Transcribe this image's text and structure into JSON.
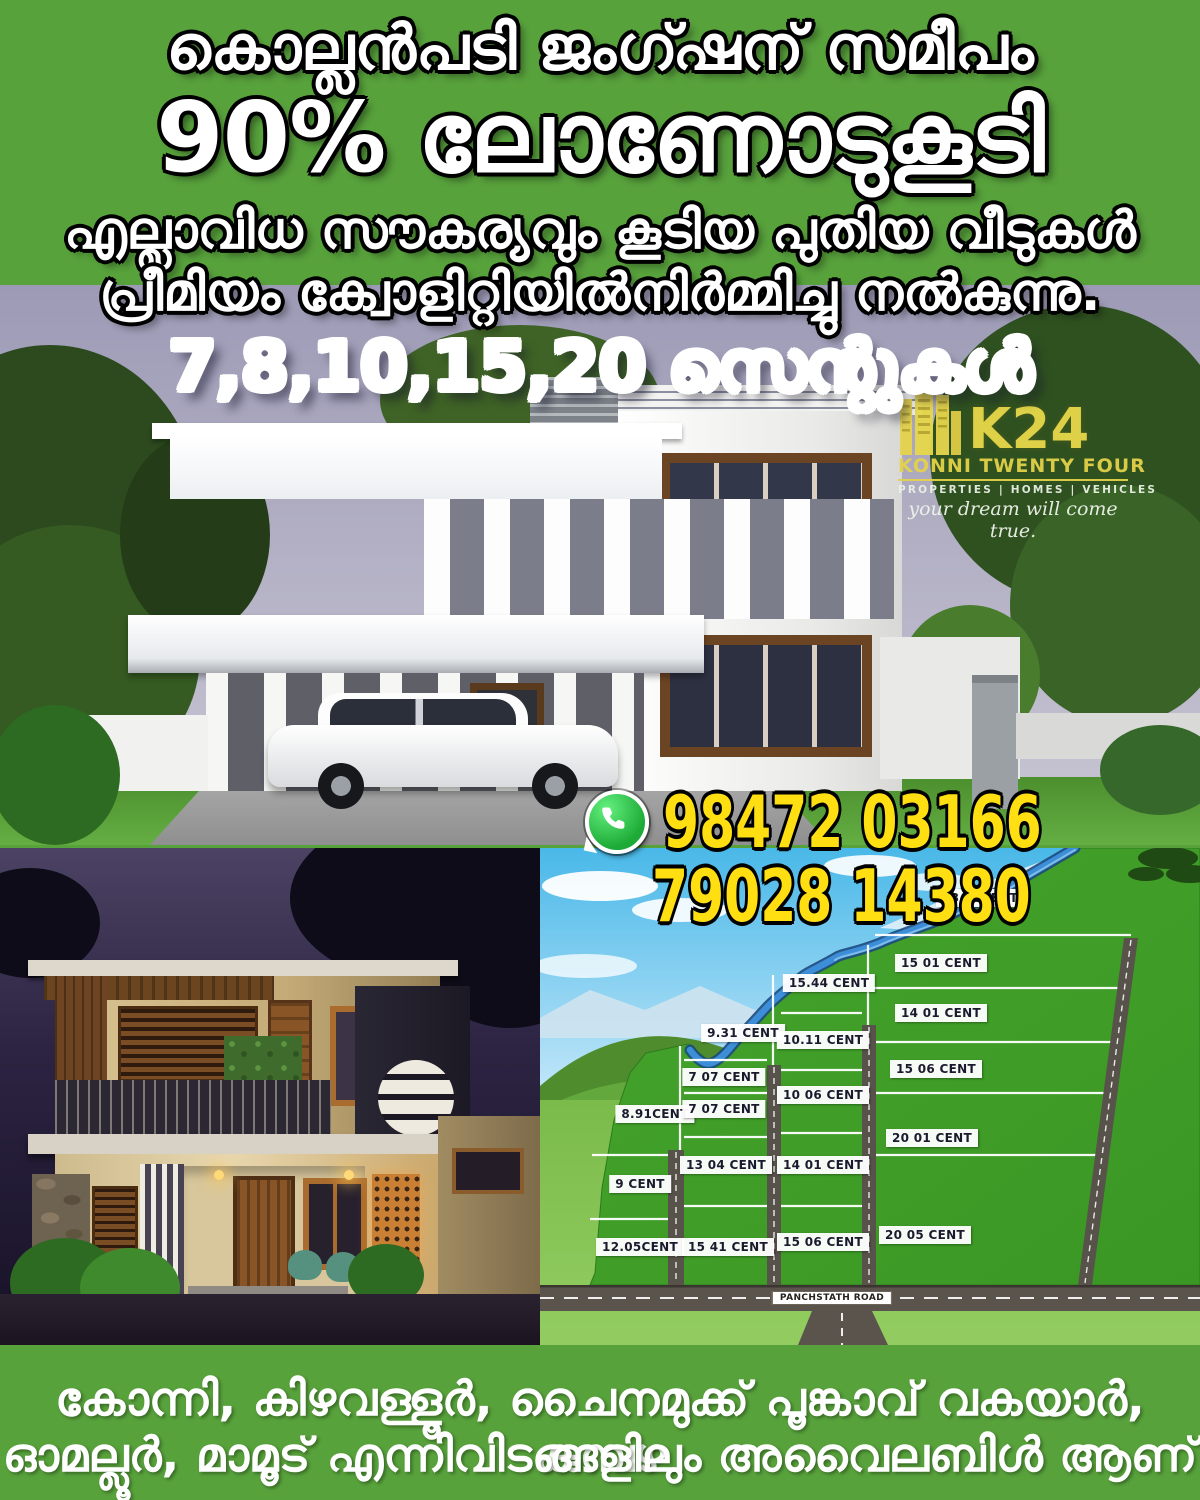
{
  "header": {
    "line1": "കൊല്ലൻപടി ജംഗ്ഷന് സമീപം",
    "line2": "90% ലോണോടുകൂടി",
    "line3": "എല്ലാവിധ സൗകര്യവും കൂടിയ പുതിയ വീടുകൾ",
    "line4": "പ്രീമിയം ക്വോളിറ്റിയിൽനിർമ്മിച്ചു നൽകുന്നു.",
    "cents_line": "7,8,10,15,20 സെന്റുകൾ"
  },
  "logo": {
    "name": "K24",
    "line1": "KONNI TWENTY FOUR",
    "line2": "PROPERTIES | HOMES | VEHICLES",
    "tagline": "your dream will come true.",
    "buildings_icon": "city-buildings-icon"
  },
  "contact": {
    "whatsapp_icon": "whatsapp-icon",
    "phone1": "98472 03166",
    "phone2": "79028 14380"
  },
  "map": {
    "road_label": "PANCHSTATH ROAD",
    "plots": [
      {
        "label": "8.91CENT",
        "x": 115,
        "y": 266
      },
      {
        "label": "9 CENT",
        "x": 100,
        "y": 336
      },
      {
        "label": "12.05CENT",
        "x": 100,
        "y": 399
      },
      {
        "label": "9.31 CENT",
        "x": 203,
        "y": 185
      },
      {
        "label": "7 07 CENT",
        "x": 184,
        "y": 229
      },
      {
        "label": "7 07 CENT",
        "x": 184,
        "y": 261
      },
      {
        "label": "13 04 CENT",
        "x": 186,
        "y": 317
      },
      {
        "label": "15 41 CENT",
        "x": 188,
        "y": 399
      },
      {
        "label": "15.44 CENT",
        "x": 289,
        "y": 135
      },
      {
        "label": "10.11 CENT",
        "x": 283,
        "y": 192
      },
      {
        "label": "10 06 CENT",
        "x": 283,
        "y": 247
      },
      {
        "label": "14 01 CENT",
        "x": 283,
        "y": 317
      },
      {
        "label": "15 06 CENT",
        "x": 283,
        "y": 394
      },
      {
        "label": "13.00CENT",
        "x": 440,
        "y": 50
      },
      {
        "label": "15 01 CENT",
        "x": 401,
        "y": 115
      },
      {
        "label": "14 01 CENT",
        "x": 401,
        "y": 165
      },
      {
        "label": "15 06 CENT",
        "x": 396,
        "y": 221
      },
      {
        "label": "20 01 CENT",
        "x": 392,
        "y": 290
      },
      {
        "label": "20 05 CENT",
        "x": 385,
        "y": 387
      }
    ]
  },
  "footer": {
    "line1": "കോന്നി, കിഴവള്ളൂർ, ചൈനമുക്ക് പൂങ്കാവ് വകയാർ,  കുമ്പഴ",
    "line2": "ഓമല്ലൂർ, മാമൂട് എന്നിവിടങ്ങളിലും അവൈലബിൾ ആണ്"
  },
  "colors": {
    "background_green": "#58a23c",
    "phone_yellow": "#ffdf12",
    "whatsapp_green": "#1daa37",
    "cents_gradient_top": "#3fb9c9",
    "cents_gradient_bottom": "#2c2f80",
    "plot_green": "#3f9d27",
    "map_sky_blue": "#49b8e8",
    "river_blue": "#3c8ed8",
    "road_gray": "#5a544c",
    "logo_yellow": "#e8d84b"
  }
}
